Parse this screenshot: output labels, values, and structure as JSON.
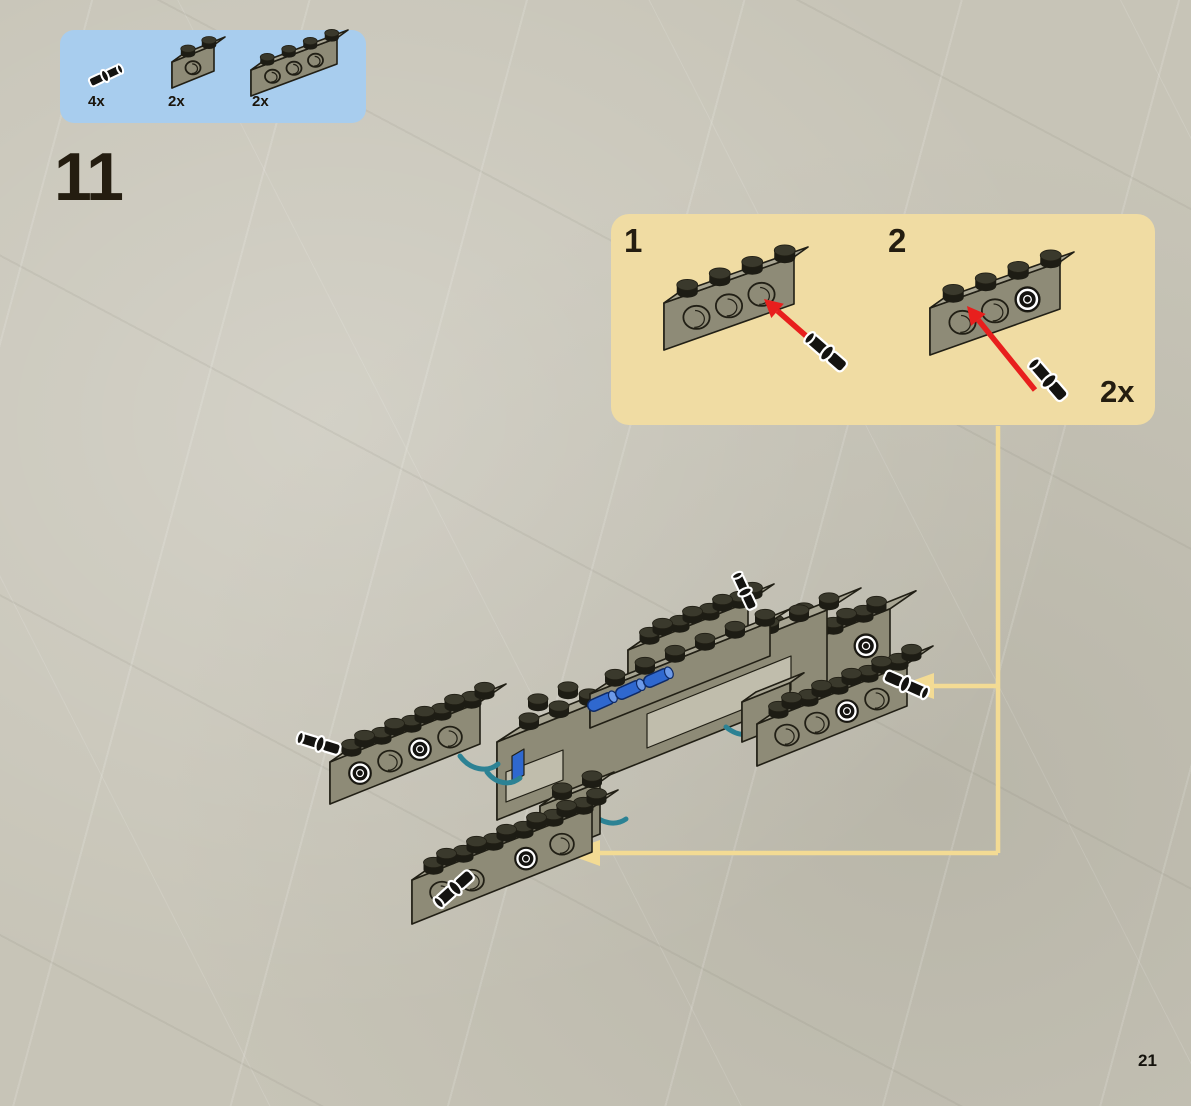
{
  "page": {
    "number": "21"
  },
  "step": {
    "number": "11"
  },
  "parts_box": {
    "bg_color": "#a8cdee",
    "items": [
      {
        "qty": "4x",
        "part": "technic-pin"
      },
      {
        "qty": "2x",
        "part": "technic-brick-1x2-one-hole"
      },
      {
        "qty": "2x",
        "part": "technic-brick-1x4-three-holes"
      }
    ]
  },
  "callout": {
    "bg_color": "#f0dca3",
    "quantity": "2x",
    "substeps": [
      {
        "label": "1",
        "description": "insert technic pin into end hole of 1x4 technic brick"
      },
      {
        "label": "2",
        "description": "insert second technic pin into next hole of 1x4 technic brick"
      }
    ]
  },
  "model": {
    "description": "partially built chassis with four technic-brick outrigger arms",
    "arrow_targets": [
      "right-arm-brick",
      "bottom-arm-brick"
    ]
  },
  "colors": {
    "page_bg": "#c7c4b7",
    "connector_yellow": "#f3db94",
    "arrow_red": "#e81f1d",
    "outline": "#211f15",
    "brick_top": "#a8a593",
    "brick_front": "#8e8b77",
    "brick_side": "#6c6a59",
    "brick_light": "#c0bdac",
    "stud_dark": "#1d1c14",
    "stud_top": "#3a392c",
    "pin_black": "#141310",
    "pin_outline": "#ffffff",
    "pin_blue": "#2f68cf",
    "hose_teal": "#2c8294",
    "text": "#1b150b"
  }
}
